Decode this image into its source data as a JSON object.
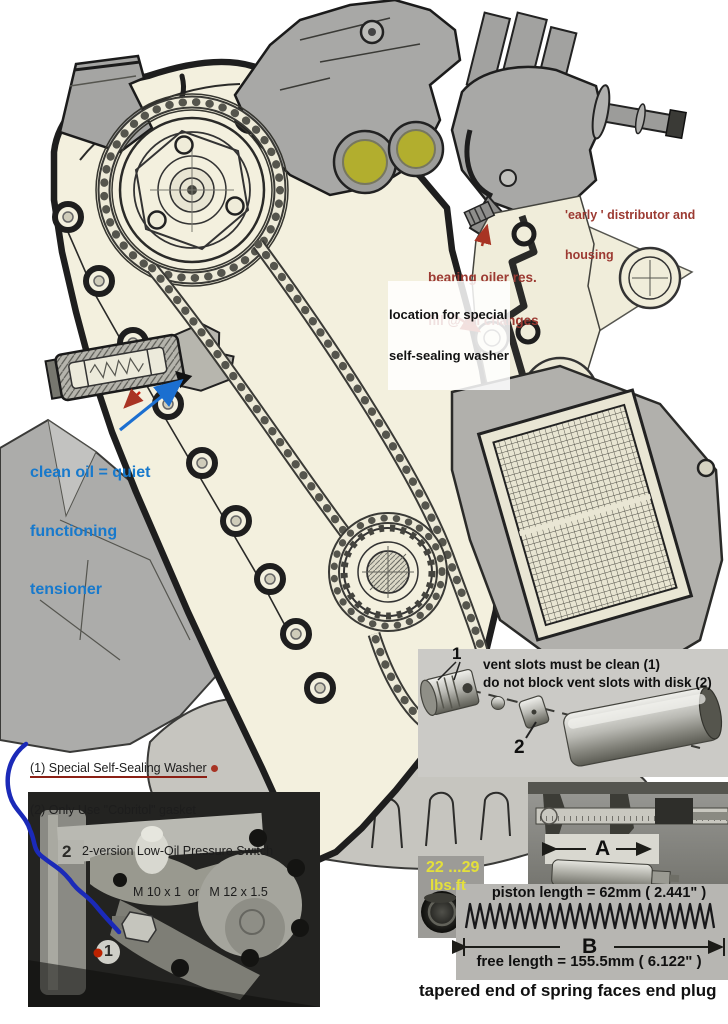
{
  "palette": {
    "red_annotation": "#9c3a32",
    "blue_annotation": "#1779cc",
    "yellow_label": "#e4e03a",
    "cover_cream": "#f3f0de",
    "inset_grey": "#cbcac6"
  },
  "main_labels": {
    "early_distributor_l1": "'early ' distributor and",
    "early_distributor_l2": "housing",
    "bearing_oiler_l1": "bearing oiler res.",
    "bearing_oiler_l2": "fill @ oil changes",
    "washer_loc_l1": "location for special",
    "washer_loc_l2": "self-sealing washer",
    "tensioner_l1": "clean oil = quiet",
    "tensioner_l2": "functioning",
    "tensioner_l3": "tensioner"
  },
  "pressure_switch_notes": {
    "line1": "(1) Special Self-Sealing Washer",
    "line2": "(2) Only Use \"Cobritol\" gasket",
    "line3": "2-version Low-Oil Pressure Switch",
    "line4": "M 10 x 1  or   M 12 x 1.5"
  },
  "photo_labels": {
    "two": "2",
    "one": "1"
  },
  "vent_inset": {
    "line1": "vent slots must be clean (1)",
    "line2": "do not block vent slots with disk (2)",
    "label_1": "1",
    "label_2": "2"
  },
  "measurements": {
    "torque_l1": "22 ...29",
    "torque_l2": "lbs.ft",
    "label_a": "A",
    "piston_length": "piston length = 62mm ( 2.441\" )",
    "label_b": "B",
    "free_length": "free length = 155.5mm ( 6.122\" )",
    "caption": "tapered end of spring faces end plug"
  }
}
